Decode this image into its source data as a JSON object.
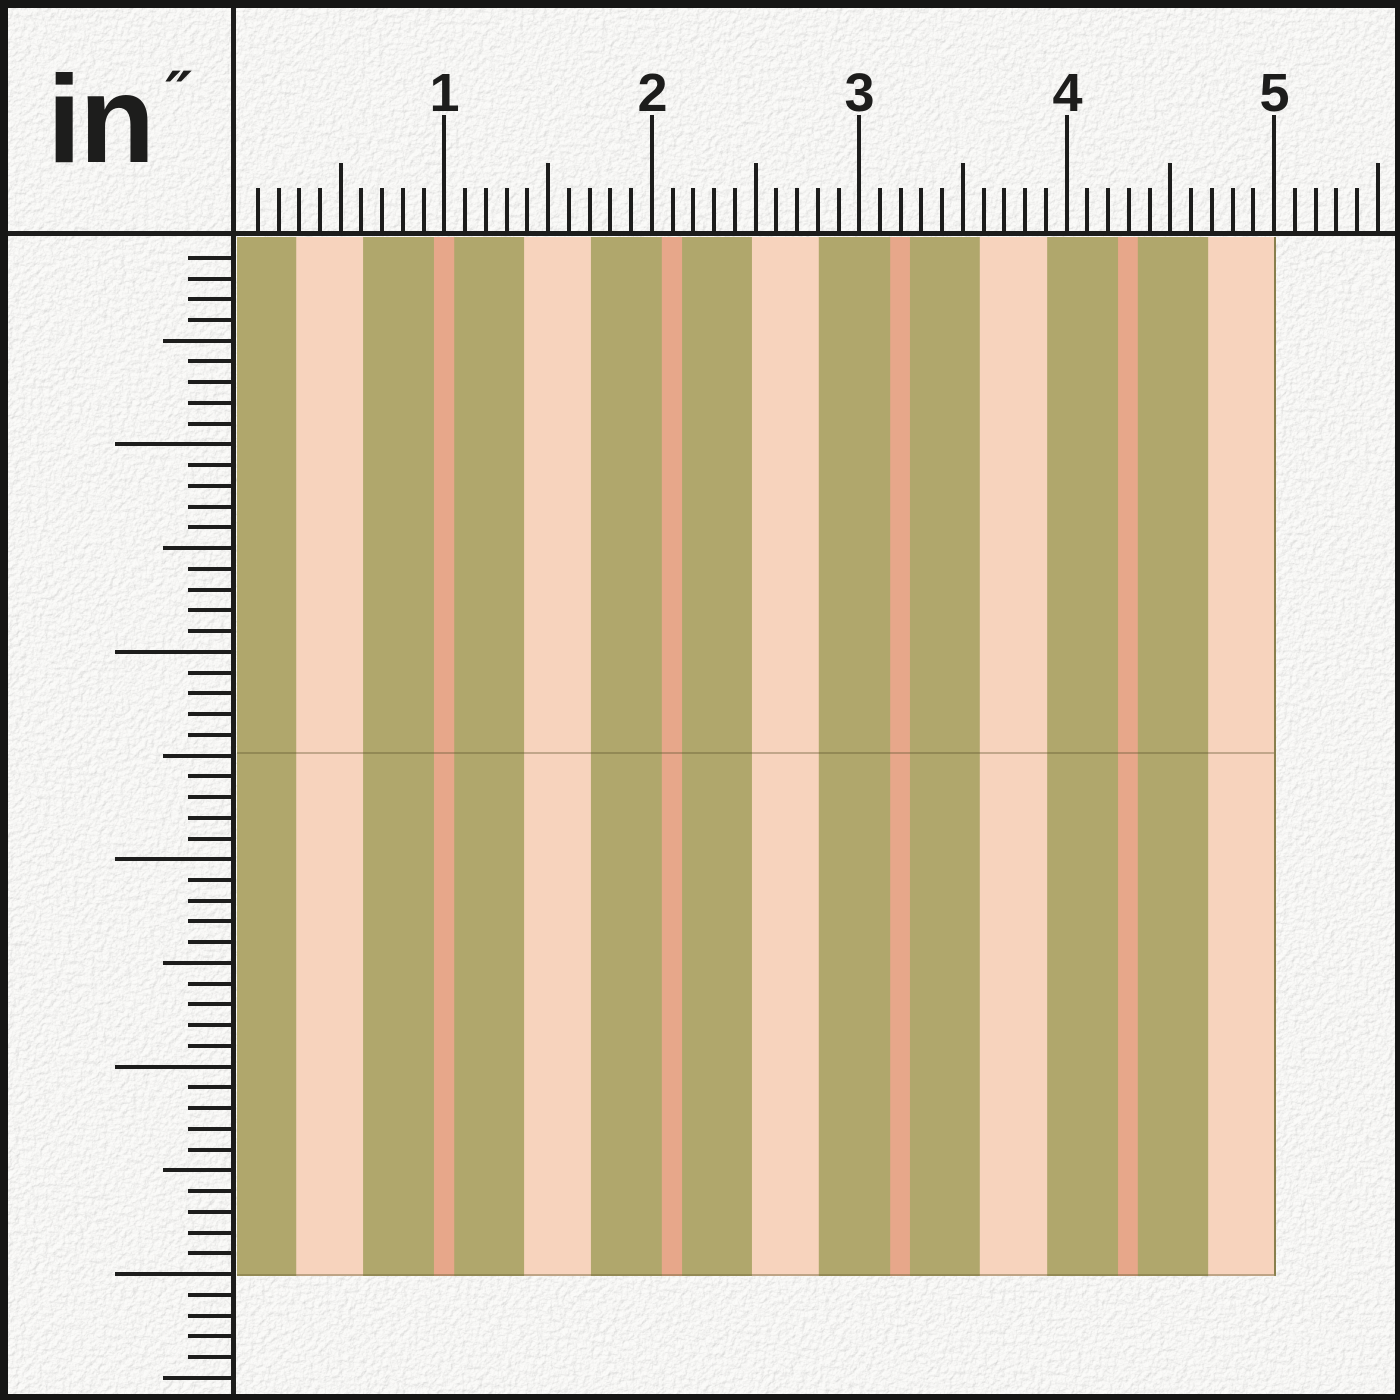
{
  "unit_label": {
    "text": "in",
    "mark": "″"
  },
  "rulers": {
    "horizontal": {
      "unit": "inch",
      "numbers": [
        "1",
        "2",
        "3",
        "4",
        "5"
      ],
      "divisions_per_inch": 10,
      "visible_length_inches": 5.5
    },
    "vertical": {
      "unit": "inch",
      "numbers": [
        "1",
        "2",
        "3",
        "4",
        "5"
      ],
      "divisions_per_inch": 10,
      "visible_length_inches": 5.5
    }
  },
  "swatch": {
    "pattern": "vertical stripes",
    "size_inches": 5,
    "colors": {
      "olive": "#b0a76c",
      "peach": "#f7d3bd",
      "salmon": "#e7a78a"
    },
    "stripe_tile": [
      {
        "color": "olive",
        "width_px": 59
      },
      {
        "color": "peach",
        "width_px": 67
      },
      {
        "color": "olive",
        "width_px": 71
      },
      {
        "color": "salmon",
        "width_px": 20
      },
      {
        "color": "olive",
        "width_px": 11
      }
    ],
    "horizontal_seam_ratio": 0.497
  },
  "ink_color": "#1d1d1c",
  "frame_color": "#161615",
  "background_color": "#ededeb"
}
